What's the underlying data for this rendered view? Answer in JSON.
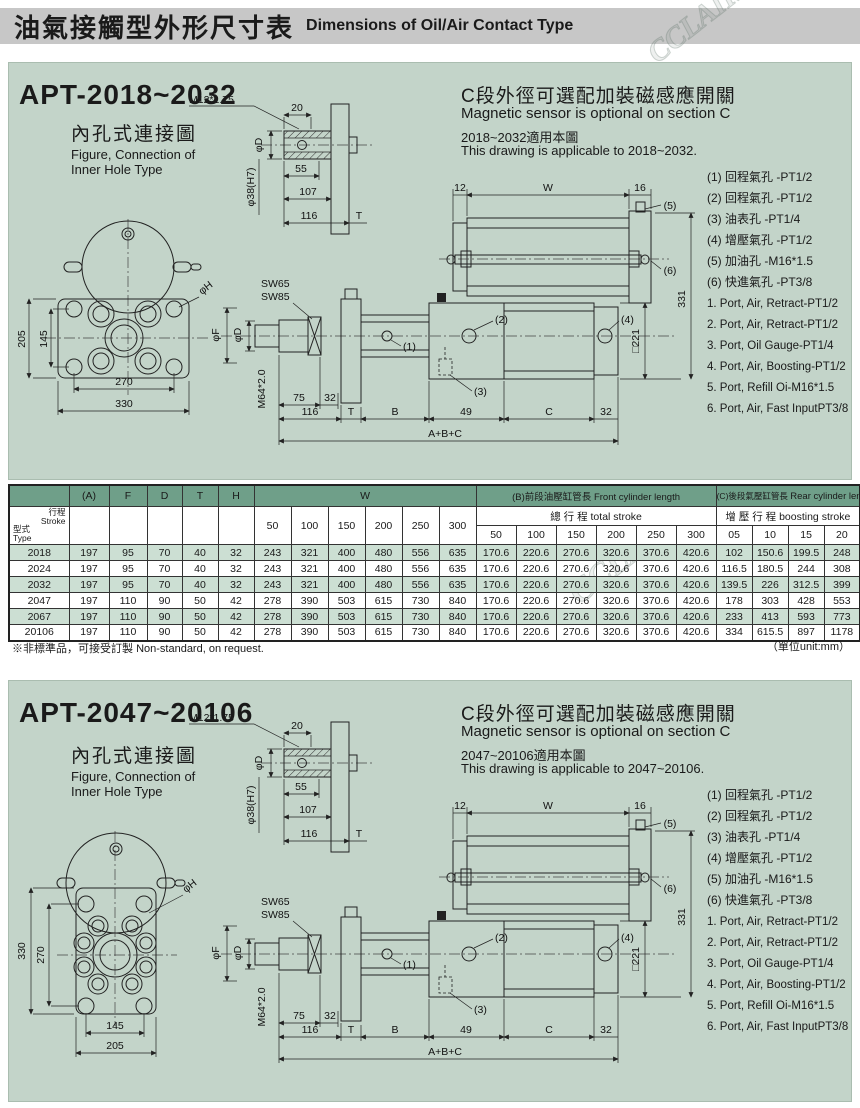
{
  "page": {
    "title_zh": "油氣接觸型外形尺寸表",
    "title_en": "Dimensions of Oil/Air Contact Type",
    "footnote_zh": "※非標準品，可接受訂製",
    "footnote_en": "Non-standard, on request.",
    "unit_note": "（單位unit:mm）",
    "watermark": "CCLAIR"
  },
  "colors": {
    "panel_bg": "#c3d4c9",
    "table_header_green": "#6f9f89",
    "row_alt_green": "#ccdfd3",
    "header_bar_gray": "#c7c7c7"
  },
  "ports_zh": [
    "(1) 回程氣孔  -PT1/2",
    "(2) 回程氣孔  -PT1/2",
    "(3) 油表孔  -PT1/4",
    "(4) 增壓氣孔  -PT1/2",
    "(5) 加油孔  -M16*1.5",
    "(6) 快進氣孔  -PT3/8"
  ],
  "ports_en": [
    "1. Port, Air, Retract-PT1/2",
    "2. Port, Air, Retract-PT1/2",
    "3. Port, Oil Gauge-PT1/4",
    "4. Port, Air, Boosting-PT1/2",
    "5. Port, Refill Oi-M16*1.5",
    "6. Port, Air, Fast InputPT3/8"
  ],
  "labels": {
    "thread": "M12*1.75",
    "d20": "20",
    "phiD": "φD",
    "phi38": "φ38(H7)",
    "d55": "55",
    "d107": "107",
    "d116": "116",
    "T": "T",
    "SW65": "SW65",
    "SW85": "SW85",
    "phiF": "φF",
    "M64": "M64*2.0",
    "d75": "75",
    "d32": "32",
    "B": "B",
    "d12": "12",
    "W": "W",
    "d16": "16",
    "d331": "331",
    "sq221": "□221",
    "d49": "49",
    "C": "C",
    "ABC": "A+B+C",
    "phiH": "φH",
    "c1": "(1)",
    "c2": "(2)",
    "c3": "(3)",
    "c4": "(4)",
    "c5": "(5)",
    "c6": "(6)"
  },
  "sections": [
    {
      "title": "APT-2018~2032",
      "conn_zh": "內孔式連接圖",
      "conn_en1": "Figure, Connection of",
      "conn_en2": "Inner Hole Type",
      "opt_zh": "C段外徑可選配加裝磁感應開關",
      "opt_en": "Magnetic sensor is optional on section C",
      "range_zh": "2018~2032適用本圖",
      "range_en": "This drawing is applicable to 2018~2032.",
      "flange": {
        "v_outer": "205",
        "v_inner": "145",
        "h_inner": "270",
        "h_outer": "330"
      }
    },
    {
      "title": "APT-2047~20106",
      "conn_zh": "內孔式連接圖",
      "conn_en1": "Figure, Connection of",
      "conn_en2": "Inner Hole Type",
      "opt_zh": "C段外徑可選配加裝磁感應開關",
      "opt_en": "Magnetic sensor is optional on section C",
      "range_zh": "2047~20106適用本圖",
      "range_en": "This drawing is applicable to 2047~20106.",
      "flange": {
        "v_outer": "330",
        "v_inner": "270",
        "h_inner": "145",
        "h_outer": "205"
      }
    }
  ],
  "table": {
    "corner_top_zh": "行程",
    "corner_top_en": "Stroke",
    "corner_bottom_zh": "型式",
    "corner_bottom_en": "Type",
    "col_a": "(A)",
    "col_f": "F",
    "col_d": "D",
    "col_t": "T",
    "col_h": "H",
    "col_w": "W",
    "w_cols": [
      "50",
      "100",
      "150",
      "200",
      "250",
      "300"
    ],
    "b_group_zh": "(B)前段油壓缸管長",
    "b_group_en": "Front cylinder length",
    "b_sub_zh": "總 行 程",
    "b_sub_en": "total stroke",
    "b_cols": [
      "50",
      "100",
      "150",
      "200",
      "250",
      "300"
    ],
    "c_group_zh": "(C)後段氣壓缸管長",
    "c_group_en": "Rear cylinder length",
    "c_sub_zh": "增 壓 行 程",
    "c_sub_en": "boosting stroke",
    "c_cols": [
      "05",
      "10",
      "15",
      "20"
    ],
    "rows": [
      {
        "type": "2018",
        "a": "197",
        "f": "95",
        "d": "70",
        "t": "40",
        "h": "32",
        "w": [
          "243",
          "321",
          "400",
          "480",
          "556",
          "635"
        ],
        "b": [
          "170.6",
          "220.6",
          "270.6",
          "320.6",
          "370.6",
          "420.6"
        ],
        "c": [
          "102",
          "150.6",
          "199.5",
          "248"
        ]
      },
      {
        "type": "2024",
        "a": "197",
        "f": "95",
        "d": "70",
        "t": "40",
        "h": "32",
        "w": [
          "243",
          "321",
          "400",
          "480",
          "556",
          "635"
        ],
        "b": [
          "170.6",
          "220.6",
          "270.6",
          "320.6",
          "370.6",
          "420.6"
        ],
        "c": [
          "116.5",
          "180.5",
          "244",
          "308"
        ]
      },
      {
        "type": "2032",
        "a": "197",
        "f": "95",
        "d": "70",
        "t": "40",
        "h": "32",
        "w": [
          "243",
          "321",
          "400",
          "480",
          "556",
          "635"
        ],
        "b": [
          "170.6",
          "220.6",
          "270.6",
          "320.6",
          "370.6",
          "420.6"
        ],
        "c": [
          "139.5",
          "226",
          "312.5",
          "399"
        ]
      },
      {
        "type": "2047",
        "a": "197",
        "f": "110",
        "d": "90",
        "t": "50",
        "h": "42",
        "w": [
          "278",
          "390",
          "503",
          "615",
          "730",
          "840"
        ],
        "b": [
          "170.6",
          "220.6",
          "270.6",
          "320.6",
          "370.6",
          "420.6"
        ],
        "c": [
          "178",
          "303",
          "428",
          "553"
        ]
      },
      {
        "type": "2067",
        "a": "197",
        "f": "110",
        "d": "90",
        "t": "50",
        "h": "42",
        "w": [
          "278",
          "390",
          "503",
          "615",
          "730",
          "840"
        ],
        "b": [
          "170.6",
          "220.6",
          "270.6",
          "320.6",
          "370.6",
          "420.6"
        ],
        "c": [
          "233",
          "413",
          "593",
          "773"
        ]
      },
      {
        "type": "20106",
        "a": "197",
        "f": "110",
        "d": "90",
        "t": "50",
        "h": "42",
        "w": [
          "278",
          "390",
          "503",
          "615",
          "730",
          "840"
        ],
        "b": [
          "170.6",
          "220.6",
          "270.6",
          "320.6",
          "370.6",
          "420.6"
        ],
        "c": [
          "334",
          "615.5",
          "897",
          "1178"
        ]
      }
    ]
  }
}
